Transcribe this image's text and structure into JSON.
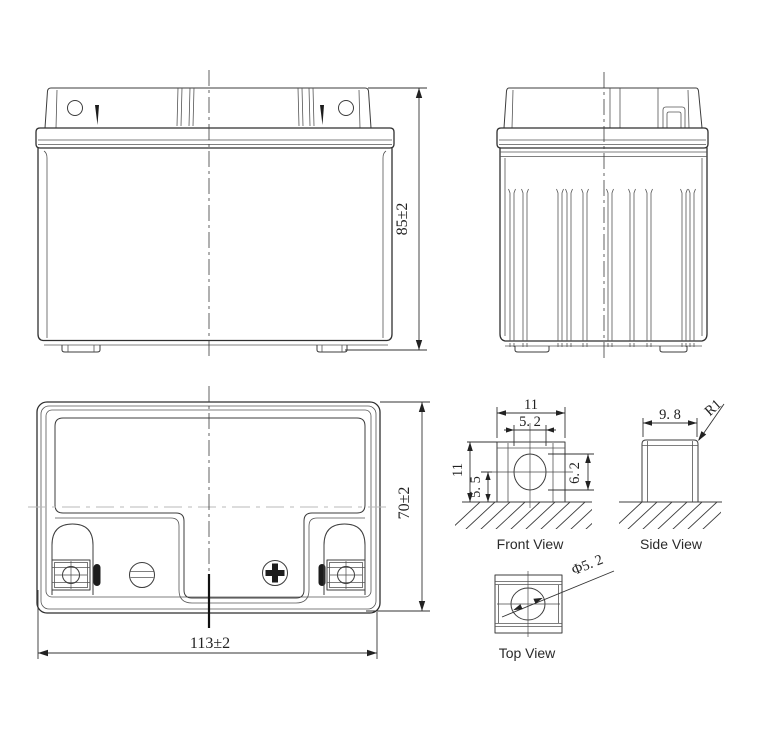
{
  "drawing": {
    "labels": {
      "front_view": "Front View",
      "side_view": "Side View",
      "top_view": "Top View"
    },
    "dimensions": {
      "overall_height": "85±2",
      "overall_width": "113±2",
      "overall_depth": "70±2",
      "terminal_width": "11",
      "terminal_height": "11",
      "terminal_hole_width": "5. 2",
      "terminal_hole_center_height": "5. 5",
      "terminal_hole_height": "6. 2",
      "terminal_depth": "9. 8",
      "terminal_corner_radius": "R1",
      "terminal_hole_diameter": "Φ5. 2"
    },
    "colors": {
      "line": "#2f2f2f",
      "background": "#ffffff"
    }
  }
}
